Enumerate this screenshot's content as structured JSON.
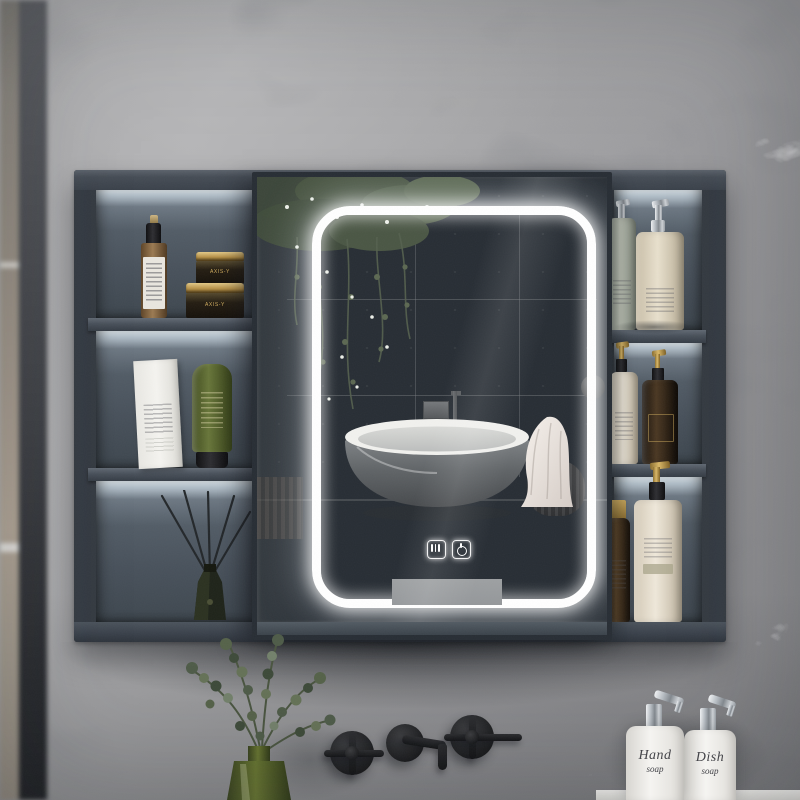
{
  "meta": {
    "description": "Product photo of a wall-mounted dark gray bathroom mirror cabinet with an LED-lit sliding mirror, open side shelves holding cosmetics, above a matte black wall faucet, a green glass vase with eucalyptus and two soap dispensers, all against a gray marble wall"
  },
  "palette": {
    "wall_marble": "#a3a3a5",
    "cabinet_body": "#3b424b",
    "cabinet_interior": "#49525c",
    "led_light": "#ffffff",
    "accent_gold": "#c2a05a",
    "matte_black": "#1d1e20",
    "cream_bottle": "#e5dcc8",
    "olive_green": "#5c6a33",
    "soap_white": "#f2f1ee"
  },
  "mirror": {
    "touch_icons": [
      {
        "name": "defog"
      },
      {
        "name": "power"
      }
    ],
    "reflection": [
      "concrete wall",
      "hanging greenery",
      "freestanding bathtub",
      "wall tub faucet",
      "draped towel",
      "pleated stool",
      "round vase"
    ]
  },
  "shelves": {
    "left": [
      {
        "items": [
          "amber glass spray bottle",
          "stacked black and gold cosmetic jars"
        ]
      },
      {
        "items": [
          "white cosmetic box",
          "green cosmetic tube"
        ]
      },
      {
        "items": [
          "reed diffuser with black sticks"
        ]
      }
    ],
    "right": [
      {
        "items": [
          "green glass pump bottle",
          "cream pump bottle"
        ]
      },
      {
        "items": [
          "cream gold-pump bottle",
          "dark amber gold-pump bottle"
        ]
      },
      {
        "items": [
          "small amber bottle",
          "large cream gold-pump bottle"
        ]
      }
    ]
  },
  "labels": {
    "jar_brand": "AXIS-Y",
    "soap_1": {
      "line1": "Hand",
      "line2": "soap"
    },
    "soap_2": {
      "line1": "Dish",
      "line2": "soap"
    }
  },
  "fixtures": {
    "faucet": "matte black wall-mounted set: two cross handles and a center spout",
    "vase": "green glass vase with eucalyptus branches",
    "counter_items": [
      "hand soap dispenser",
      "dish soap dispenser"
    ]
  }
}
